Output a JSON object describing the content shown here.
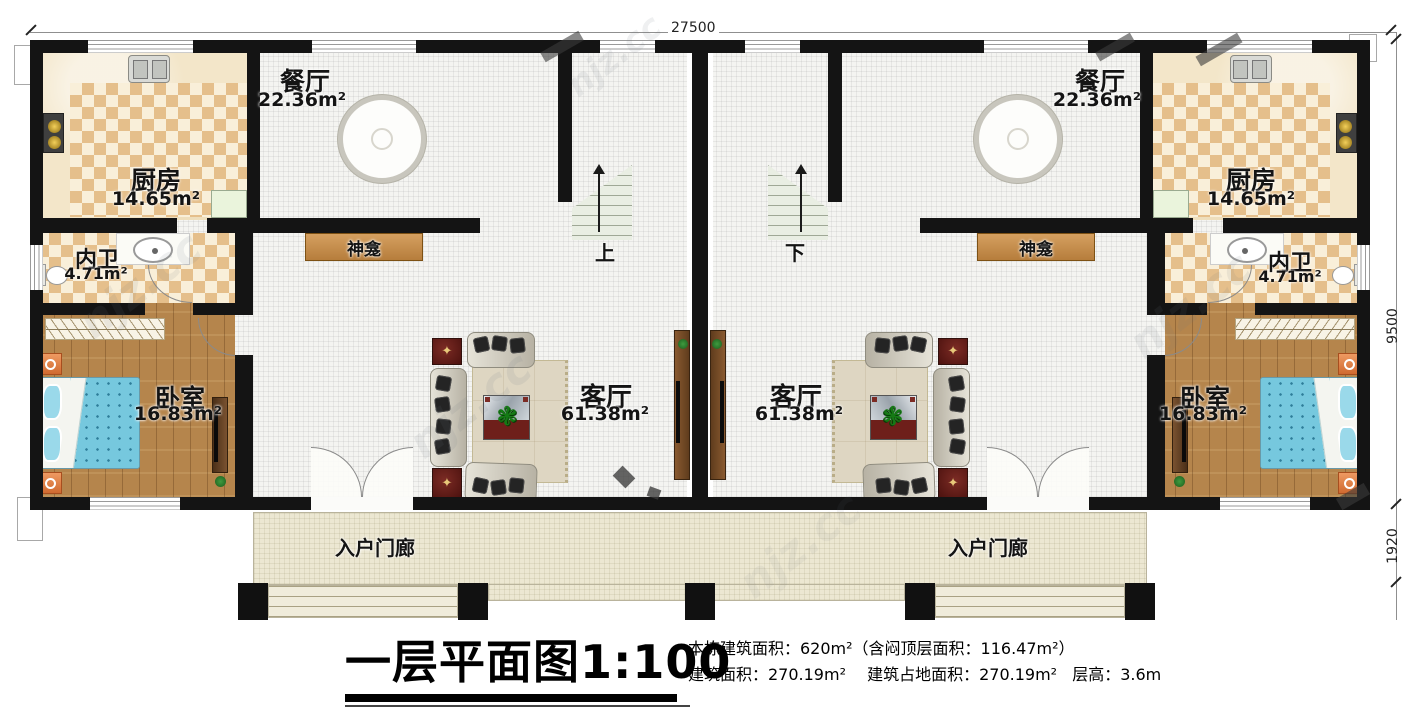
{
  "plan": {
    "dimensions": {
      "top_width": "27500",
      "right_height": "9500",
      "right_porch": "1920"
    },
    "rooms": {
      "dining": {
        "name": "餐厅",
        "area": "22.36m²"
      },
      "kitchen": {
        "name": "厨房",
        "area": "14.65m²"
      },
      "bathroom": {
        "name": "内卫",
        "area": "4.71m²"
      },
      "bedroom": {
        "name": "卧室",
        "area": "16.83m²"
      },
      "living": {
        "name": "客厅",
        "area": "61.38m²"
      },
      "shrine": {
        "name": "神龛"
      },
      "porch": {
        "name": "入户门廊"
      }
    },
    "stairs": {
      "left_unit": "上",
      "right_unit": "下"
    }
  },
  "title_block": {
    "title": "一层平面图1:100",
    "line1": "本栋建筑面积：620m²（含闷顶层面积：116.47m²）",
    "line2_a": "建筑面积：270.19m²",
    "line2_b": "建筑占地面积：270.19m²",
    "line2_c": "层高：3.6m"
  },
  "watermark": {
    "text": "njz.cc"
  },
  "colors": {
    "wall": "#141414",
    "kitchen_tile": "#e5bf8b",
    "wood_floor": "#b5854c",
    "bed": "#76c8de",
    "shrine": "#c9945a",
    "porch": "#ece7d2",
    "furniture_red": "#5e1f1c"
  }
}
